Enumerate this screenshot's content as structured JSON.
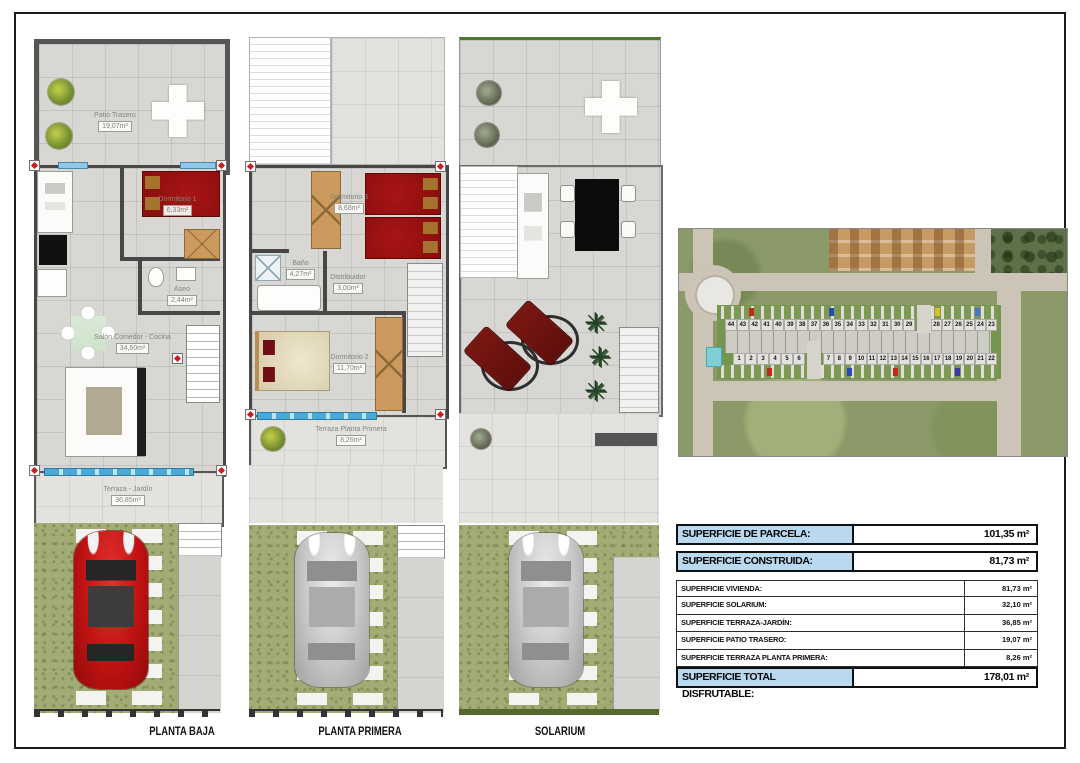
{
  "plans": [
    {
      "label": "PLANTA BAJA",
      "rooms": {
        "patio": {
          "name": "Patio Trasero",
          "area": "19,07m²"
        },
        "dorm1": {
          "name": "Dormitorio 1",
          "area": "6,33m²"
        },
        "aseo": {
          "name": "Aseo",
          "area": "2,44m²"
        },
        "salon": {
          "name": "Salón Comedor - Cocina",
          "area": "34,60m²"
        },
        "terraza": {
          "name": "Terraza - Jardín",
          "area": "36,85m²"
        }
      }
    },
    {
      "label": "PLANTA PRIMERA",
      "rooms": {
        "dorm3": {
          "name": "Dormitorio 3",
          "area": "8,68m²"
        },
        "bano": {
          "name": "Baño",
          "area": "4,27m²"
        },
        "distribuidor": {
          "name": "Distribuidor",
          "area": "3,00m²"
        },
        "dorm2": {
          "name": "Dormitorio 2",
          "area": "11,70m²"
        },
        "terraza": {
          "name": "Terraza Planta Primera",
          "area": "8,26m²"
        }
      }
    },
    {
      "label": "SOLARIUM",
      "rooms": {}
    }
  ],
  "aerial": {
    "plots_top_a": [
      "44",
      "43",
      "42",
      "41",
      "40",
      "39",
      "38",
      "37",
      "36",
      "35",
      "34",
      "33",
      "32",
      "31",
      "30",
      "29"
    ],
    "plots_top_b": [
      "28",
      "27",
      "26",
      "25",
      "24",
      "23"
    ],
    "plots_bottom_a": [
      "1",
      "2",
      "3",
      "4",
      "5",
      "6"
    ],
    "plots_bottom_b": [
      "7",
      "8",
      "9",
      "10",
      "11",
      "12",
      "13",
      "14",
      "15",
      "16",
      "17",
      "18",
      "19",
      "20",
      "21",
      "22"
    ]
  },
  "summary_table": {
    "parcela": {
      "label": "SUPERFICIE DE PARCELA:",
      "value": "101,35 m²"
    },
    "construida": {
      "label": "SUPERFICIE CONSTRUIDA:",
      "value": "81,73 m²"
    },
    "rows": [
      {
        "label": "SUPERFICIE VIVIENDA:",
        "value": "81,73 m²"
      },
      {
        "label": "SUPERFICIE SOLARIUM:",
        "value": "32,10 m²"
      },
      {
        "label": "SUPERFICIE TERRAZA-JARDÍN:",
        "value": "36,85 m²"
      },
      {
        "label": "SUPERFICIE PATIO TRASERO:",
        "value": "19,07 m²"
      },
      {
        "label": "SUPERFICIE TERRAZA PLANTA PRIMERA:",
        "value": "8,26 m²"
      }
    ],
    "total": {
      "label": "SUPERFICIE TOTAL DISFRUTABLE:",
      "value": "178,01 m²"
    }
  },
  "icons": {
    "palm": "✳"
  },
  "colors": {
    "table_header_bg": "#b9d9f0",
    "bed_red": "#a81414",
    "lawn_green": "#a2ac74",
    "window_blue": "#8fc8e8",
    "pool_cyan": "#7ecfd6"
  }
}
